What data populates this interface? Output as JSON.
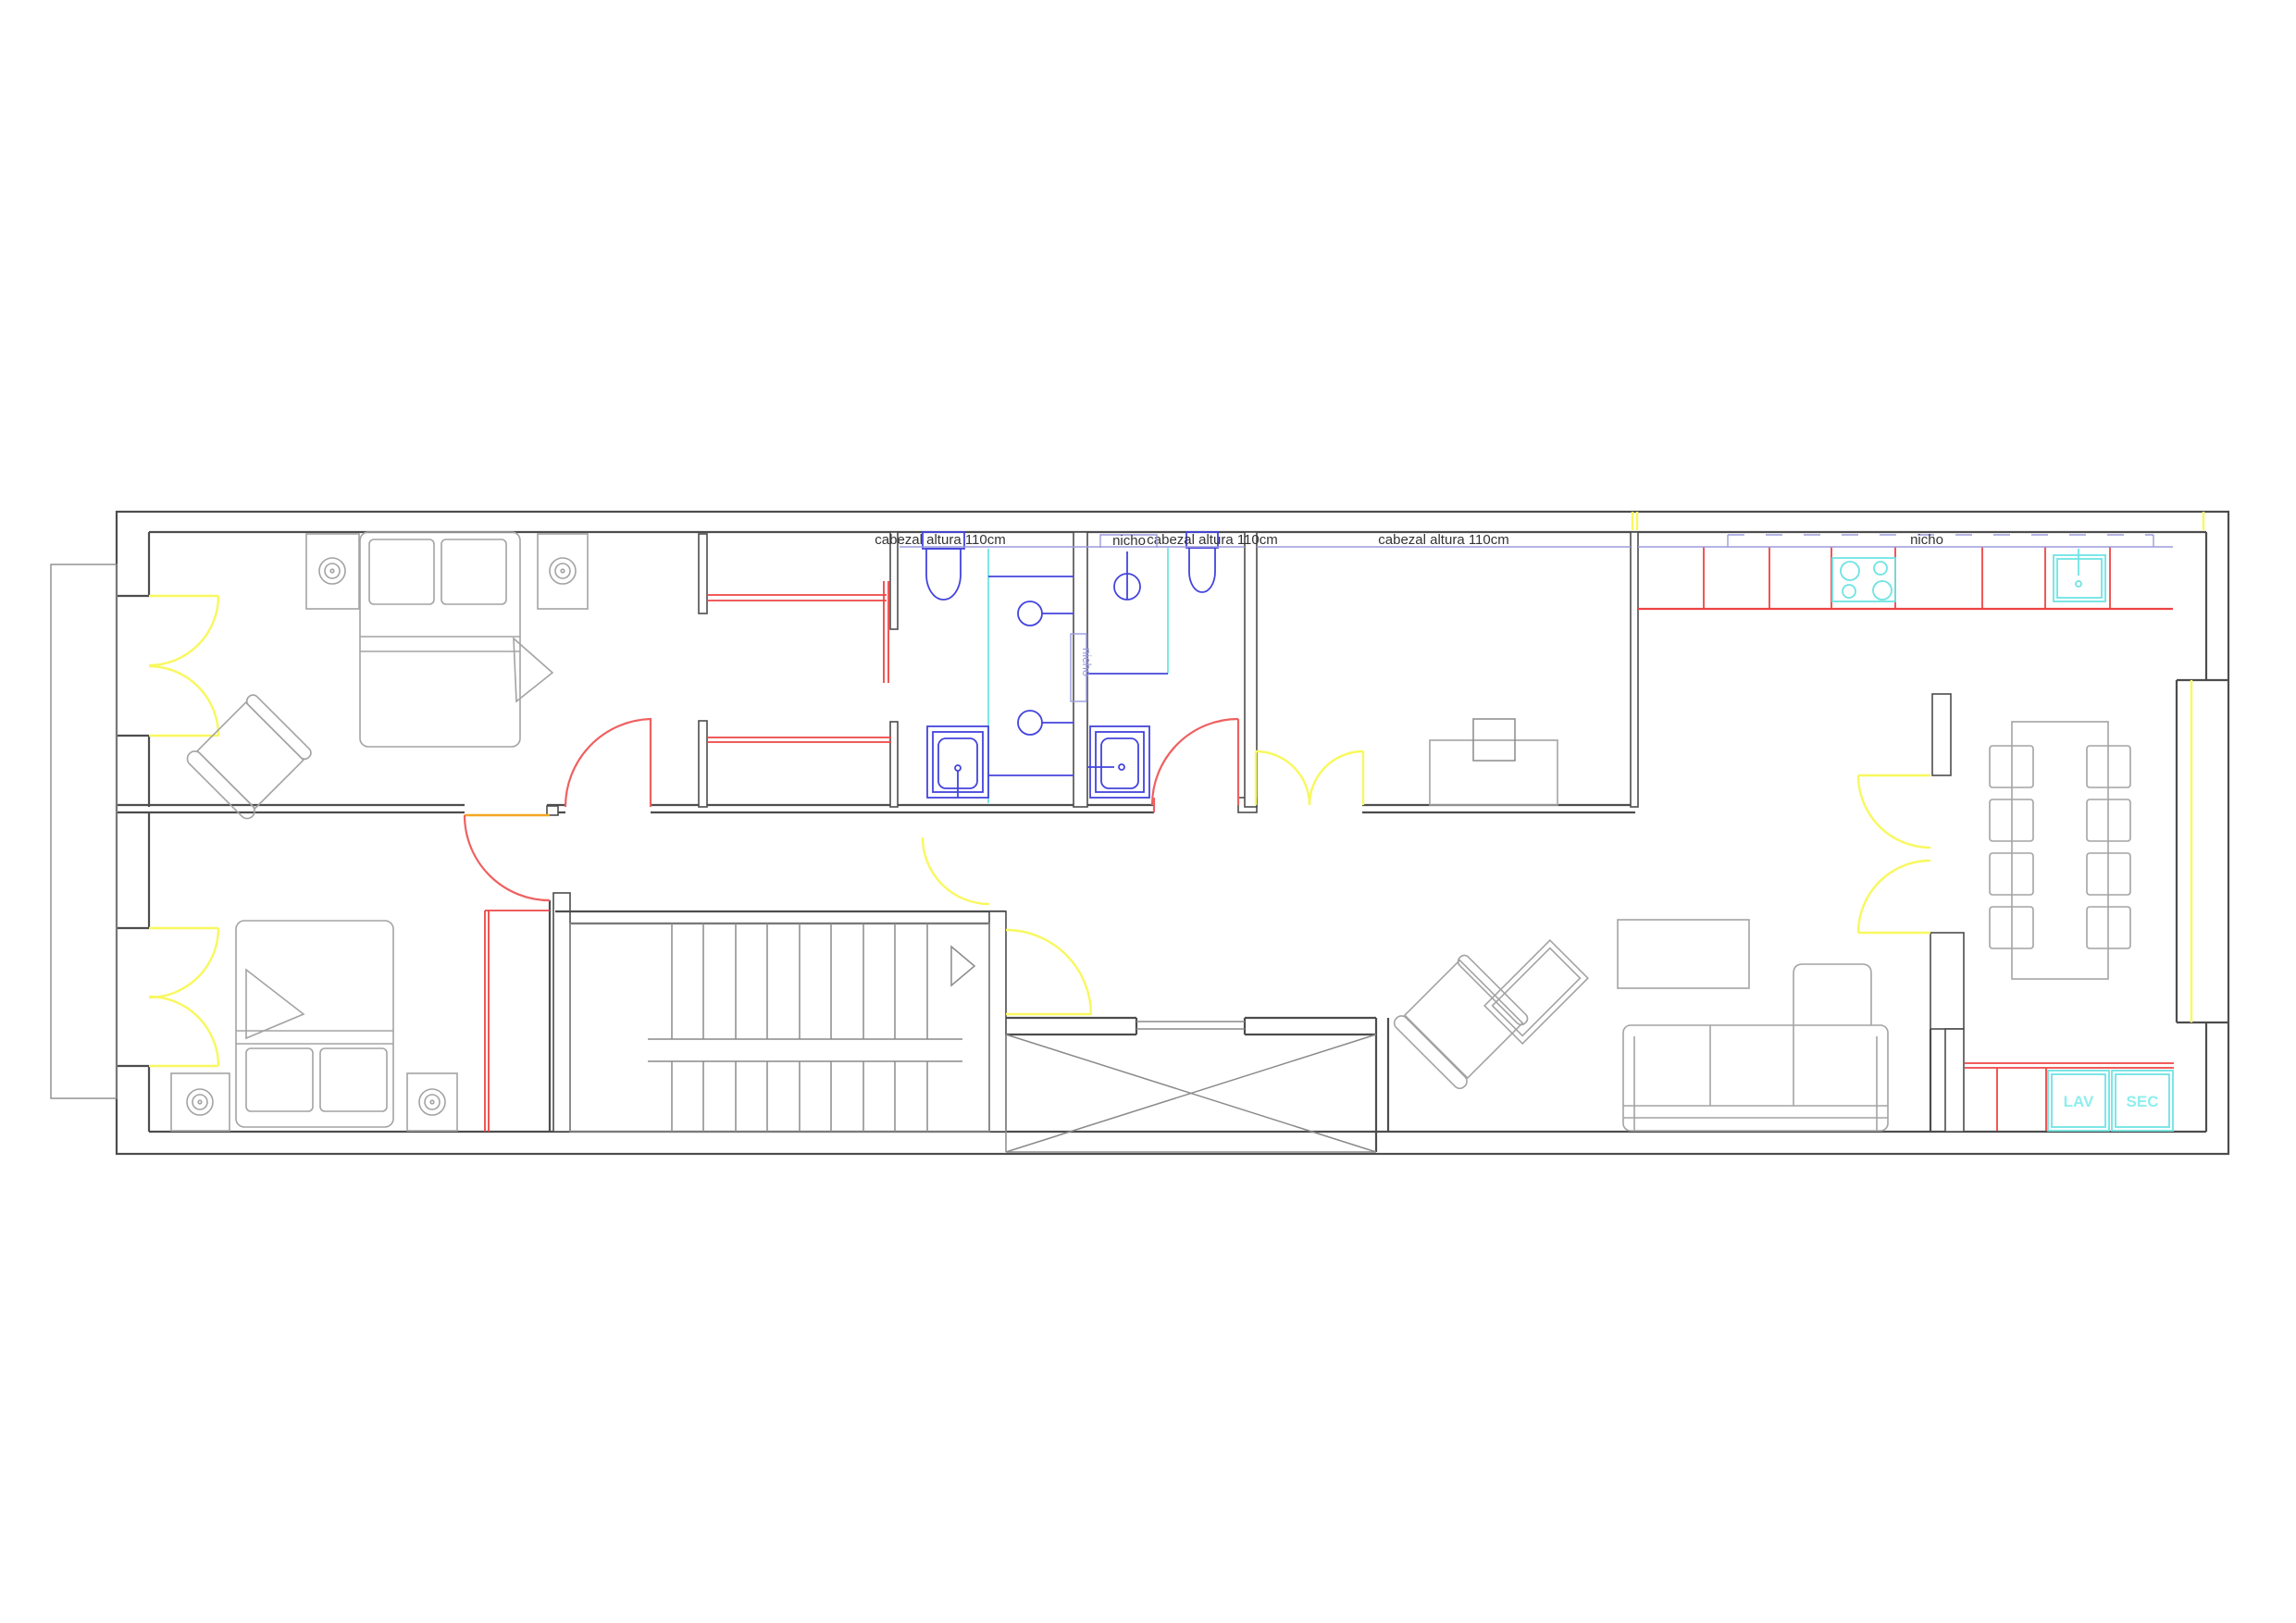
{
  "labels": {
    "headboard_left": "cabezal altura 110cm",
    "headboard_mid": "cabezal altura 110cm",
    "headboard_right": "cabezal altura 110cm",
    "niche_bath": "nicho",
    "niche_wall": "nicho",
    "niche_kitchen": "nicho",
    "washer": "LAV",
    "dryer": "SEC"
  },
  "colors": {
    "wall": "#4d4d4d",
    "wall_light": "#8c8c8c",
    "furniture": "#a3a3a3",
    "furniture_dark": "#8a8a8a",
    "door_yellow": "#f8f85e",
    "door_red": "#ef6060",
    "cabinet_red": "#ee4444",
    "threshold_orange": "#f5a623",
    "fixture_blue": "#4444dd",
    "glass_cyan": "#7de8e8",
    "appliance_cyan": "#6fe3e3",
    "appliance_label": "#8feeee",
    "annotation": "#9b9bdc",
    "text": "#333333",
    "background": "#ffffff"
  }
}
